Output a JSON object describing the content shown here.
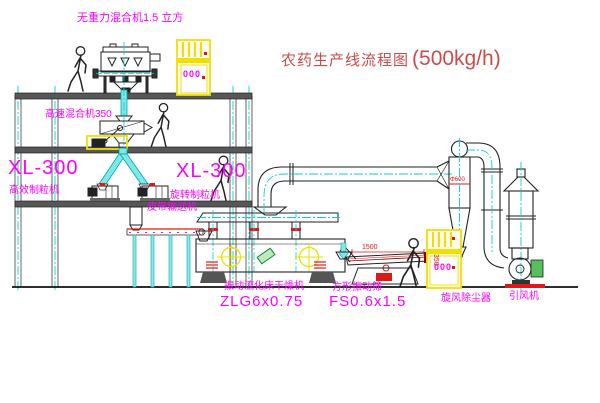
{
  "title": {
    "text": "农药生产线流程图",
    "capacity": "(500kg/h)"
  },
  "labels": {
    "gravity_mixer": "无重力混合机1.5 立方",
    "high_speed_mixer": "高速混合机350",
    "granulator_left_model": "XL-300",
    "granulator_left_name": "高效制粒机",
    "granulator_right_model": "XL-300",
    "granulator_right_name": "旋转制粒机",
    "belt_conveyor": "皮带输送机",
    "dryer_name": "振动流化床干燥机",
    "dryer_model": "ZLG6x0.75",
    "screen_name": "方形振动筛",
    "screen_model": "FS0.6x1.5",
    "cyclone": "旋风除尘器",
    "fan": "引风机"
  },
  "dimensions": {
    "screen_length": "1500",
    "screen_height": "350",
    "cyclone_dia": "Φ600"
  },
  "cabinets": {
    "upper_display": "000",
    "lower_display": "000"
  },
  "icons": {
    "person_figure": "worker silhouette",
    "crosshair": "yellow center-mark circle",
    "centerline": "cyan dash-dot line"
  },
  "colors": {
    "label_magenta": "#ff00ff",
    "title_red": "#cf4a4a",
    "dimension_red": "#e01818",
    "centerline_cyan": "#00d4d4",
    "material_cyan": "#7de8e8",
    "cabinet_yellow": "#f0e000",
    "motor_green": "#57c05c",
    "structure_gray": "#575757"
  }
}
